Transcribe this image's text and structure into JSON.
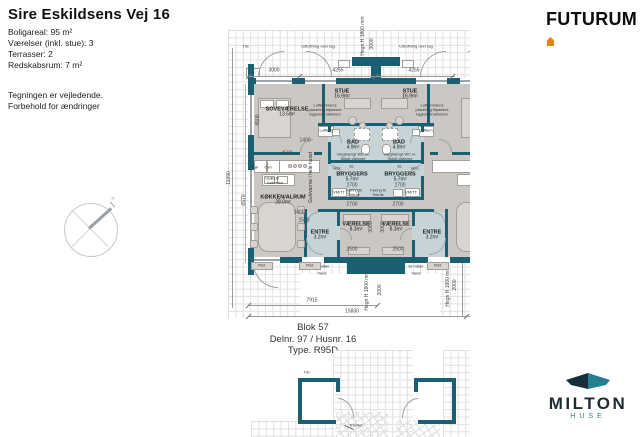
{
  "header": {
    "title": "Sire Eskildsens Vej 16",
    "specs": [
      "Boligareal: 95 m²",
      "Værelser (inkl. stue): 3",
      "Terrasser: 2",
      "Redskabsrum: 7 m²"
    ],
    "notes": [
      "Tegningen er vejledende.",
      "Forbehold for ændringer"
    ]
  },
  "branding": {
    "futurum": "FUTURUM",
    "milton": "MILTON",
    "milton_sub": "HUSE"
  },
  "plan": {
    "block": {
      "line1": "Blok 57",
      "line2": "Delnr. 97 / Husnr. 16",
      "line3": "Type. R95D"
    },
    "rooms": [
      {
        "name": "SOVEVÆRELSE",
        "area": "13.5m²"
      },
      {
        "name": "STUE",
        "area": "16.9m²"
      },
      {
        "name": "BAD",
        "area": "4.9m²"
      },
      {
        "name": "BRYGGERS",
        "area": "5.7m²"
      },
      {
        "name": "KØKKEN/ALRUM",
        "area": "28.0m²"
      },
      {
        "name": "ENTRE",
        "area": "3.2m²"
      },
      {
        "name": "VÆRELSE",
        "area": "8.3m²"
      }
    ],
    "labels": {
      "udluftning": "Udluftning over tag",
      "hegn": "Hegn H 1800 mm",
      "luftlem_note": "Luftlemmens\nplacering tilpasses\ntagkonstruktionen",
      "wc_note": "Væghængt WC m.\nSkjult cisterne",
      "gulvvarme": "Gulvvarme i hele huset",
      "el_kokken": "El til køkkenø",
      "foring": "Føring til\nTeknik",
      "vmtt": "VM/TT",
      "elmaaler": "El-måler",
      "vand": "Vand",
      "rist": "Rist.",
      "luftlem": "Luftlem",
      "vent": "Vent.",
      "el": "EL",
      "kol": "Køl",
      "ovn": "Ovn",
      "opv": "Opv",
      "tromler": "Tromler",
      "tilv": "Tilv.",
      "north": "N"
    },
    "dims": {
      "d3000": "3000",
      "d4255": "4255",
      "d4500": "4500",
      "d6570": "6570",
      "d11990": "11990",
      "d1400": "1400",
      "d1500": "1500",
      "d2700": "2700",
      "d2500": "2500",
      "d2000": "2000",
      "d7915": "7915",
      "d15830": "15830"
    }
  },
  "colors": {
    "wall": "#1a6072",
    "floor": "#cbc7c3",
    "bath_floor": "#c6d4d8",
    "accent_orange": "#e8830d",
    "milton_navy": "#1d2b35",
    "milton_teal": "#3a7a85",
    "grid": "#e2e0de"
  }
}
